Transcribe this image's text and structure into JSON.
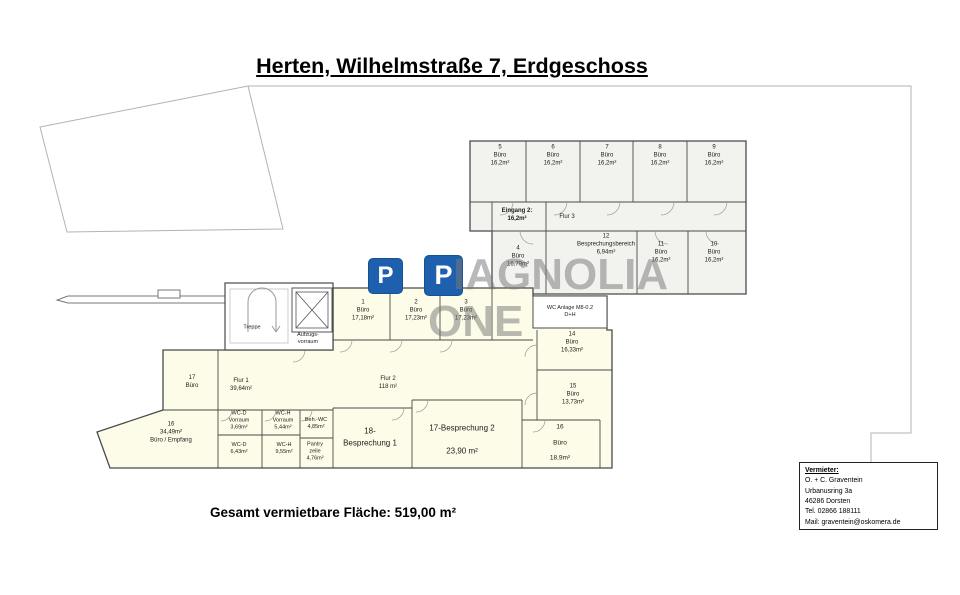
{
  "title": "Herten, Wilhelmstraße 7, Erdgeschoss",
  "summary": "Gesamt vermietbare Fläche: 519,00 m²",
  "watermark": {
    "tile_letter": "P",
    "word_top": "IAGNOLIA",
    "word_bottom": "ONE"
  },
  "colors": {
    "logo_blue": "#1e5fae",
    "office_fill_yellow": "#fdfce8",
    "office_fill_gray": "#f2f2ee",
    "wall": "#4a4a4a",
    "boundary_gray": "#b3b3b3",
    "watermark_gray": "#787878"
  },
  "rooms": [
    {
      "text": "5\nBüro\n16,2m²"
    },
    {
      "text": "6\nBüro\n16,2m²"
    },
    {
      "text": "7\nBüro\n16,2m²"
    },
    {
      "text": "8\nBüro\n16,2m²"
    },
    {
      "text": "9\nBüro\n16,2m²"
    },
    {
      "text": "Eingang 2:\n16,2m²"
    },
    {
      "text": "Flur 3"
    },
    {
      "text": "4\nBüro\n16,79m²"
    },
    {
      "text": "12\nBesprechungsbereich\n6,94m²"
    },
    {
      "text": "11\nBüro\n16,2m²"
    },
    {
      "text": "10\nBüro\n16,2m²"
    },
    {
      "text": "WC Anlage M8-0.2\nD+H"
    },
    {
      "text": "1\nBüro\n17,18m²"
    },
    {
      "text": "2\nBüro\n17,23m²"
    },
    {
      "text": "3\nBüro\n17,23m²"
    },
    {
      "text": "14\nBüro\n16,33m²"
    },
    {
      "text": "15\nBüro\n13,73m²"
    },
    {
      "text": "17\nBüro"
    },
    {
      "text": "Flur 1\n39,64m²"
    },
    {
      "text": "Flur 2\n118 m²"
    },
    {
      "text": "16\n34,49m²\nBüro / Empfang"
    },
    {
      "text": "WC-D\nVorraum\n3,69m²"
    },
    {
      "text": "WC-D\n6,43m²"
    },
    {
      "text": "WC-H\nVorraum\n5,44m²"
    },
    {
      "text": "WC-H\n9,55m²"
    },
    {
      "text": "Beh.-WC\n4,85m²"
    },
    {
      "text": "Pantry\nzeile\n4,76m²"
    },
    {
      "text": "18-\nBesprechung 1"
    },
    {
      "text": "17-Besprechung 2\n\n23,90 m²"
    },
    {
      "text": "16\nBüro\n18,9m²"
    },
    {
      "text": "Treppe"
    },
    {
      "text": "Aufzugs-\nvorraum"
    }
  ],
  "landlord": {
    "heading": "Vermieter:",
    "lines": [
      "O. + C. Graventein",
      "Urbanusring 3a",
      "46286 Dorsten",
      "Tel. 02866 188111",
      "Mail: graventein@oskomera.de"
    ]
  }
}
